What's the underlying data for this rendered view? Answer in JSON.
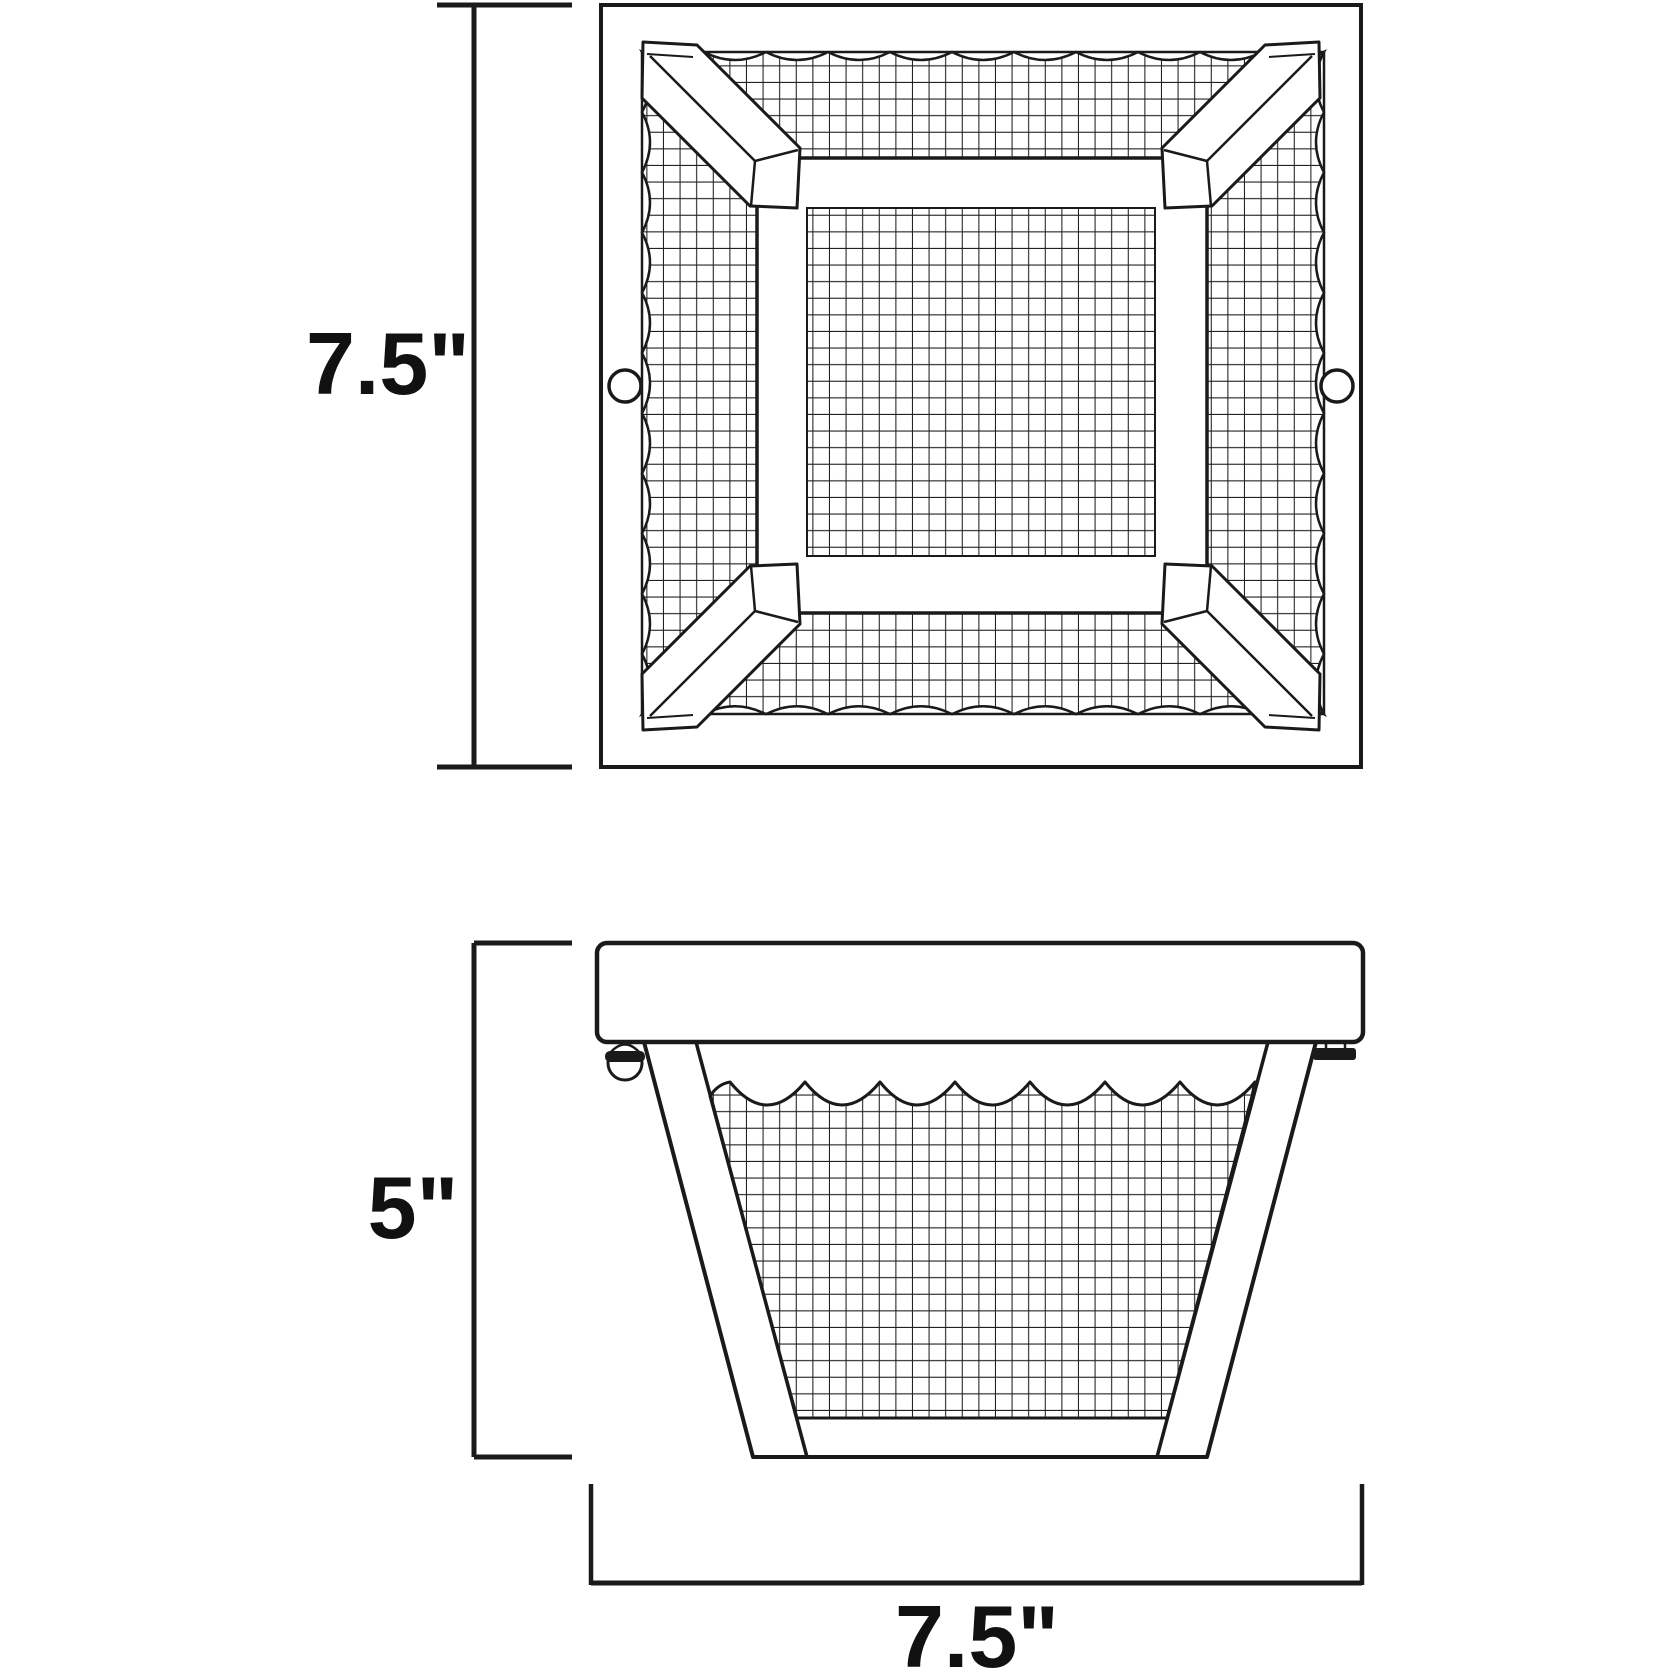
{
  "canvas": {
    "background": "#ffffff",
    "line_color": "#1a1a1a",
    "text_color": "#111111"
  },
  "diagram": {
    "kind": "product-dimension-drawing",
    "views": [
      {
        "id": "top-view",
        "dimensions": [
          {
            "axis": "height",
            "label": "7.5\""
          }
        ]
      },
      {
        "id": "front-view",
        "dimensions": [
          {
            "axis": "height",
            "label": "5\""
          },
          {
            "axis": "width",
            "label": "7.5\""
          }
        ]
      }
    ],
    "labels": {
      "top_view_height": "7.5\"",
      "front_view_height": "5\"",
      "front_view_width": "7.5\""
    }
  }
}
